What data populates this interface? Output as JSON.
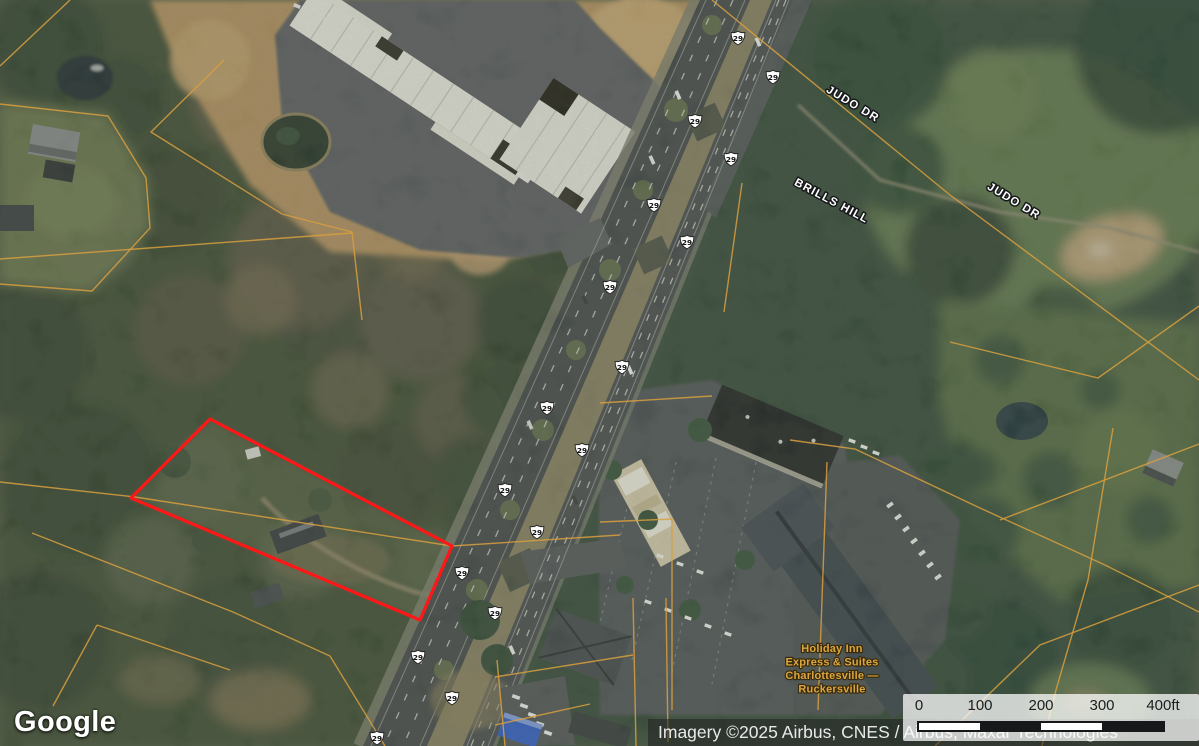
{
  "map": {
    "provider_logo": "Google",
    "attribution": "Imagery ©2025 Airbus, CNES / Airbus, Maxar Technologies",
    "road_labels": [
      {
        "text": "JUDO DR",
        "x": 851,
        "y": 107,
        "rotation": 31
      },
      {
        "text": "BRILLS HILL",
        "x": 830,
        "y": 204,
        "rotation": 28
      },
      {
        "text": "JUDO DR",
        "x": 1012,
        "y": 204,
        "rotation": 31
      }
    ],
    "poi_label": {
      "lines": [
        "Holiday Inn",
        "Express & Suites",
        "Charlottesville —",
        "Ruckersville"
      ],
      "x": 832,
      "y": 652,
      "line_height": 13.5,
      "color": "#dba63e"
    },
    "route_shields": {
      "number": "29",
      "positions": [
        [
          738,
          38
        ],
        [
          773,
          77
        ],
        [
          695,
          121
        ],
        [
          731,
          159
        ],
        [
          654,
          205
        ],
        [
          687,
          242
        ],
        [
          610,
          287
        ],
        [
          622,
          367
        ],
        [
          547,
          408
        ],
        [
          582,
          450
        ],
        [
          505,
          490
        ],
        [
          537,
          532
        ],
        [
          462,
          573
        ],
        [
          495,
          613
        ],
        [
          418,
          657
        ],
        [
          452,
          698
        ],
        [
          377,
          738
        ]
      ]
    },
    "parcel_highlight": {
      "color": "#ff1717",
      "points": [
        [
          210,
          419
        ],
        [
          452,
          546
        ],
        [
          420,
          620
        ],
        [
          131,
          498
        ]
      ]
    },
    "parcel_line_color": "#d89f3e"
  },
  "scale_bar": {
    "tick_labels": [
      "0",
      "100",
      "200",
      "300",
      "400ft"
    ],
    "bar_colors": [
      "#ffffff",
      "#17181a",
      "#ffffff",
      "#17181a"
    ]
  }
}
